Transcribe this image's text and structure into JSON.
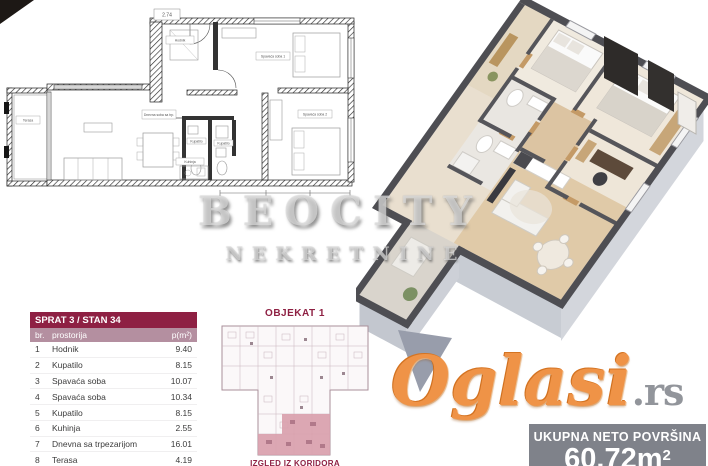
{
  "watermark": {
    "brand": "BEOCITY",
    "brand_sub": "NEKRETNINE",
    "portal": "Oglasi",
    "portal_suffix": ".rs"
  },
  "unit_table": {
    "title": "SPRAT 3 / STAN 34",
    "col_num": "br.",
    "col_room": "prostorija",
    "col_area": "p(m²)",
    "rows": [
      {
        "num": "1",
        "room": "Hodnik",
        "area": "9.40"
      },
      {
        "num": "2",
        "room": "Kupatilo",
        "area": "8.15"
      },
      {
        "num": "3",
        "room": "Spavaća soba",
        "area": "10.07"
      },
      {
        "num": "4",
        "room": "Spavaća soba",
        "area": "10.34"
      },
      {
        "num": "5",
        "room": "Kupatilo",
        "area": "8.15"
      },
      {
        "num": "6",
        "room": "Kuhinja",
        "area": "2.55"
      },
      {
        "num": "7",
        "room": "Dnevna sa trpezarijom",
        "area": "16.01"
      },
      {
        "num": "8",
        "room": "Terasa",
        "area": "4.19"
      }
    ],
    "total_label": "Ukupno - Stan 34",
    "total_value": "60.72"
  },
  "building_plan": {
    "title": "OBJEKAT 1",
    "caption": "IZGLED IZ KORIDORA"
  },
  "area_box": {
    "label": "UKUPNA NETO POVRŠINA",
    "value": "60.72",
    "unit": "m",
    "unit_sup": "2"
  },
  "floorplan_2d": {
    "dim_note": "2.74",
    "labels": {
      "terrace": "Terasa",
      "living": "Dnevna soba sa trp.",
      "kitchen": "Kuhinja",
      "hall": "Hodnik",
      "bath1": "Kupatilo",
      "bath2": "Kupatilo",
      "bedroom1": "Spavaća soba 1",
      "bedroom2": "Spavaća soba 2"
    }
  },
  "colors": {
    "accent_maroon": "#8e2043",
    "table_subheader_bg": "#b48fa0",
    "table_total_bg": "#b5b2b4",
    "portal_orange": "#ef9347",
    "area_box_bg": "#7f828a",
    "plan_highlight": "#d9a0ac",
    "wall_top_3d": "#4e4e53"
  }
}
